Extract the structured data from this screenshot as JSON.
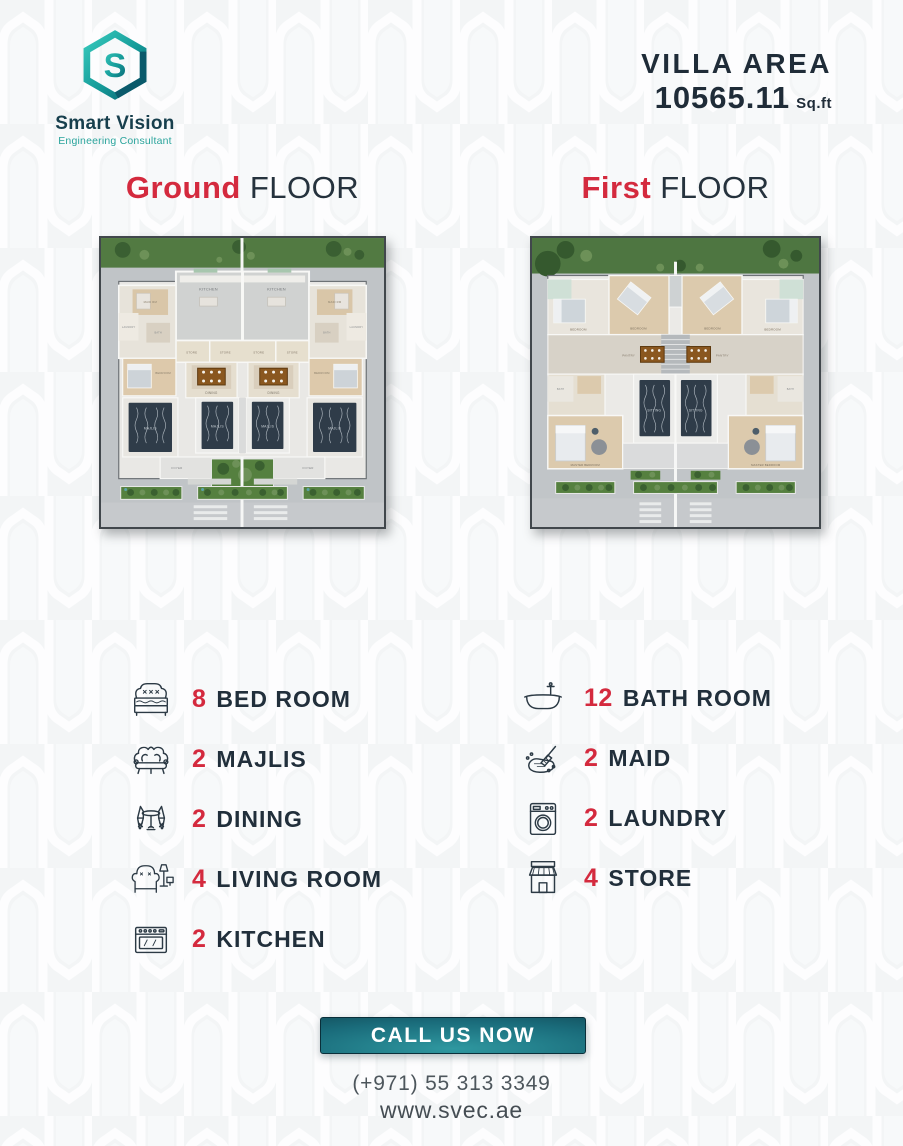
{
  "brand": {
    "name": "Smart Vision",
    "tagline": "Engineering Consultant"
  },
  "villa_area": {
    "label": "VILLA AREA",
    "value": "10565.11",
    "unit": "Sq.ft"
  },
  "floor_titles": [
    {
      "accent": "Ground",
      "rest": "FLOOR"
    },
    {
      "accent": "First",
      "rest": "FLOOR"
    }
  ],
  "plans": {
    "ground": {
      "labels": {
        "kitchen": "KITCHEN",
        "store": "STORE",
        "dining": "DINING",
        "majlis": "MAJLIS",
        "foyer": "FOYER",
        "laundry": "LAUNDRY",
        "maid": "MAID RM",
        "bath": "BATH",
        "bedroom": "BEDROOM"
      }
    },
    "first": {
      "labels": {
        "bedroom": "BEDROOM",
        "pantry": "PANTRY",
        "sitting": "SITTING",
        "master": "MASTER BEDROOM",
        "bath": "BATH"
      }
    }
  },
  "features": {
    "left": [
      {
        "icon": "bed-icon",
        "count": "8",
        "label": "BED ROOM"
      },
      {
        "icon": "sofa-icon",
        "count": "2",
        "label": "MAJLIS"
      },
      {
        "icon": "dining-chairs-icon",
        "count": "2",
        "label": "DINING"
      },
      {
        "icon": "armchair-lamp-icon",
        "count": "4",
        "label": "LIVING ROOM"
      },
      {
        "icon": "stove-icon",
        "count": "2",
        "label": "KITCHEN"
      }
    ],
    "right": [
      {
        "icon": "bathtub-icon",
        "count": "12",
        "label": "BATH ROOM"
      },
      {
        "icon": "cleaning-icon",
        "count": "2",
        "label": "MAID"
      },
      {
        "icon": "washing-machine-icon",
        "count": "2",
        "label": "LAUNDRY"
      },
      {
        "icon": "storefront-icon",
        "count": "4",
        "label": "STORE"
      }
    ]
  },
  "cta": {
    "button": "CALL US NOW",
    "phone": "(+971) 55 313 3349",
    "website": "www.svec.ae"
  },
  "colors": {
    "accent_red": "#d42a3e",
    "dark_navy": "#212f3b",
    "teal_light": "#35c7bb",
    "teal_dark": "#0a5f70",
    "button_teal": "#1a6c7b"
  }
}
